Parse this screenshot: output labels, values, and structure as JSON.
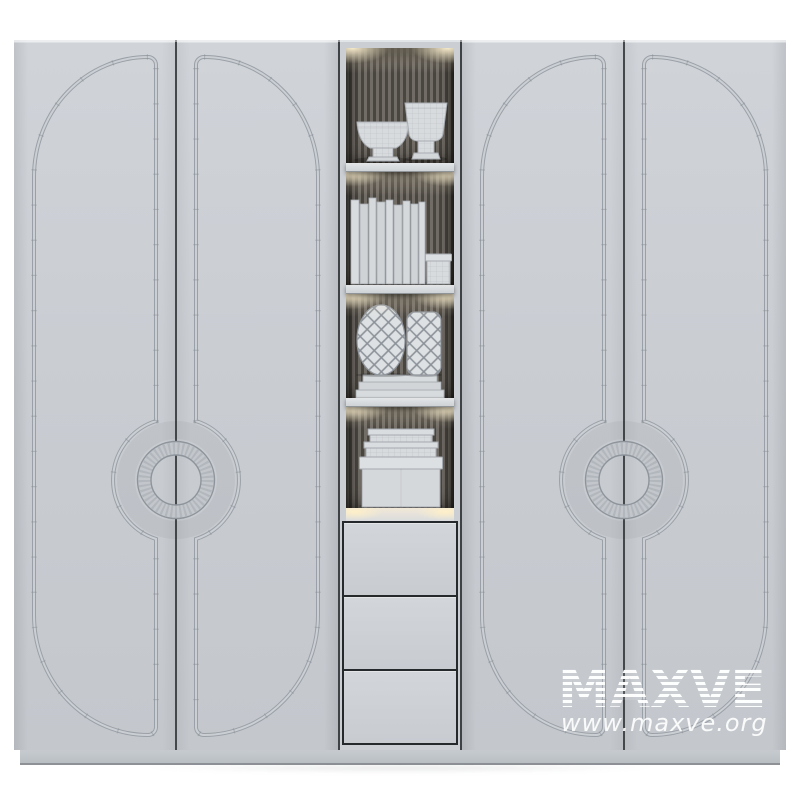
{
  "watermark": {
    "brand": "MAXVE",
    "url": "www.maxve.org"
  },
  "palette": {
    "background": "#ffffff",
    "door_gray": "#c9cdd2",
    "molding_line": "#9aa0a7",
    "seam_dark": "#3f4245",
    "niche_back_slat": "#716c66",
    "niche_back_groove": "#49453f",
    "shelf": "#d4d7da",
    "light_glow": "#fff2d2",
    "drawer_outline": "#26292c",
    "plinth": "#c0c4c9",
    "watermark_white": "#ffffff"
  },
  "furniture": {
    "type": "wardrobe render",
    "door_count": 4,
    "handle_style": "ring",
    "left_pair": {
      "doors": [
        "left-door",
        "right-door"
      ],
      "handle": "center ring handle"
    },
    "right_pair": {
      "doors": [
        "left-door",
        "right-door"
      ],
      "handle": "center ring handle"
    },
    "center_column": {
      "shelf_sections": [
        {
          "items": [
            "wide pedestal vase",
            "goblet vase"
          ]
        },
        {
          "items": [
            "row of standing books",
            "small storage box"
          ]
        },
        {
          "items": [
            "egg lattice vase",
            "cylinder lattice vase",
            "stack of flat books"
          ]
        },
        {
          "items": [
            "two flat lid boxes",
            "large storage box"
          ]
        }
      ],
      "drawer_count": 3,
      "lighting": "warm under-shelf spotlights",
      "back_panel": "vertical slats"
    }
  }
}
